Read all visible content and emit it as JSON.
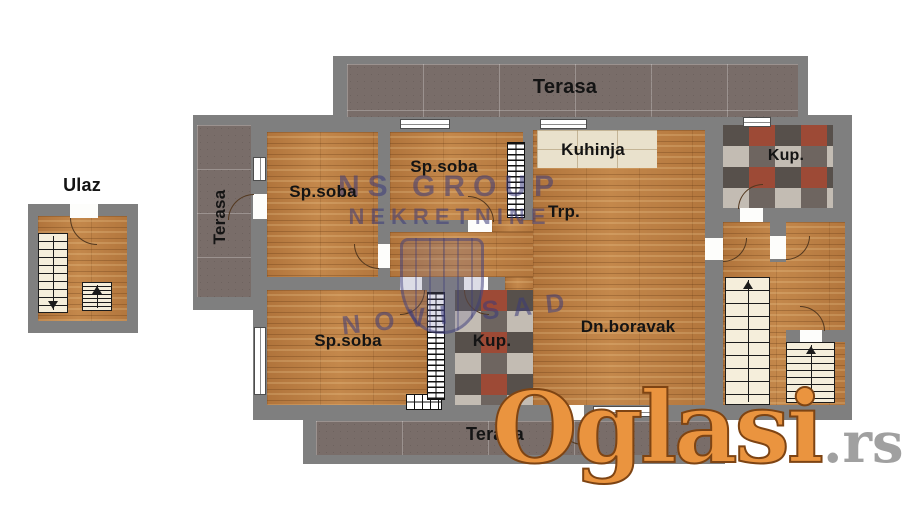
{
  "plan": {
    "entrance": {
      "label": "Ulaz"
    },
    "terraces": {
      "top": "Terasa",
      "left": "Terasa",
      "bottom": "Terasa"
    },
    "rooms": {
      "bedroom_top_left": "Sp.soba",
      "bedroom_top_mid": "Sp.soba",
      "bedroom_bottom": "Sp.soba",
      "kitchen": "Kuhinja",
      "dining": "Trp.",
      "bathroom_top_right": "Kup.",
      "bathroom_middle": "Kup.",
      "living_room": "Dn.boravak"
    }
  },
  "watermarks": {
    "agency": {
      "line1": "NS GROUP",
      "line2": "NEKRETNINE",
      "line3": "NOVI SAD"
    },
    "brand": {
      "name": "Oglasi",
      "tld": ".rs"
    }
  },
  "colors": {
    "wall_gray": "#7f7f7f",
    "wood_floor": "#bd8044",
    "terrace_tile": "#796d69",
    "kitchen_tile": "#e9e1cc",
    "bathroom_tile_accent": "#9d4a36",
    "stair_cream": "#f5eedb",
    "brand_orange": "#ea943f",
    "brand_gray": "#a0a0a0",
    "agency_blue": "#3a3a7a",
    "label_black": "#141414"
  }
}
